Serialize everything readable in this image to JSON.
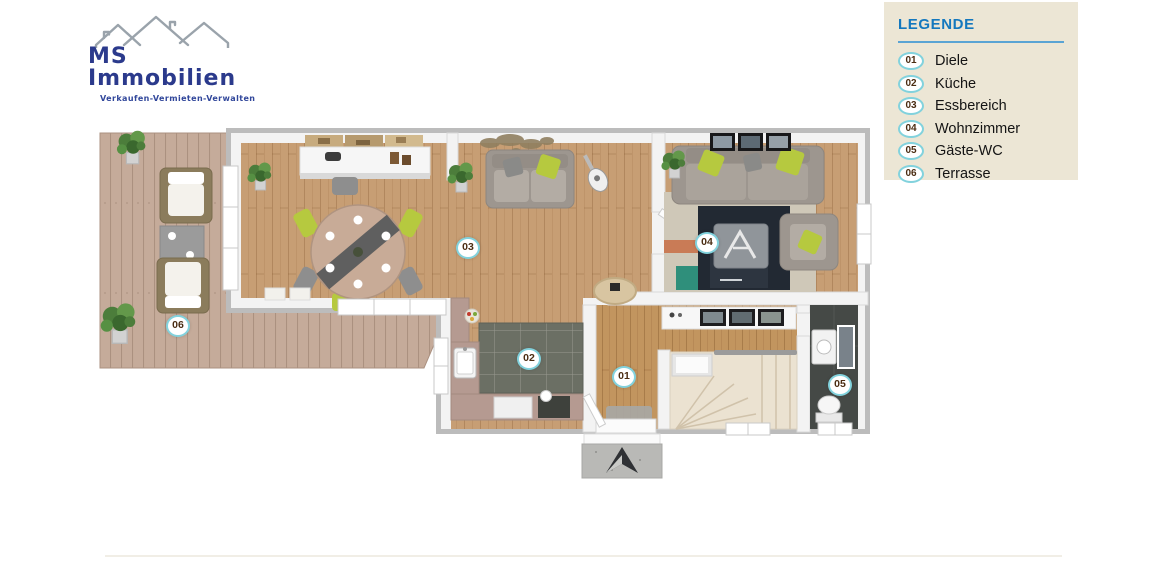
{
  "logo": {
    "name": "MS Immobilien",
    "tagline": "Verkaufen-Vermieten-Verwalten"
  },
  "legend": {
    "title": "LEGENDE",
    "items": [
      {
        "num": "01",
        "label": "Diele"
      },
      {
        "num": "02",
        "label": "Küche"
      },
      {
        "num": "03",
        "label": "Essbereich"
      },
      {
        "num": "04",
        "label": "Wohnzimmer"
      },
      {
        "num": "05",
        "label": "Gäste-WC"
      },
      {
        "num": "06",
        "label": "Terrasse"
      }
    ]
  },
  "floorplan": {
    "type": "3d-top-down-floor-plan",
    "room_markers": [
      {
        "num": "01",
        "room": "Diele",
        "x": 624,
        "y": 377
      },
      {
        "num": "02",
        "room": "Küche",
        "x": 529,
        "y": 359
      },
      {
        "num": "03",
        "room": "Essbereich",
        "x": 468,
        "y": 248
      },
      {
        "num": "04",
        "room": "Wohnzimmer",
        "x": 707,
        "y": 243
      },
      {
        "num": "05",
        "room": "Gäste-WC",
        "x": 840,
        "y": 385
      },
      {
        "num": "06",
        "room": "Terrasse",
        "x": 178,
        "y": 326
      }
    ]
  },
  "colors": {
    "logo_navy": "#2b3a8c",
    "logo_tagline": "#31479b",
    "roof_gray": "#9aa3ab",
    "legend_bg": "#ece6d5",
    "legend_blue": "#1478be",
    "legend_rule": "#5aa4d4",
    "badge_ring": "#82d2dd",
    "badge_text": "#4a2c12",
    "wall_gray": "#bcbcbc",
    "wall_white": "#f3f3f3",
    "wood_floor": "#c79e74",
    "hall_wood": "#c2955f",
    "terrace_deck": "#c5ab9a",
    "kitchen_tile": "#6b6f64",
    "counter": "#b59a91",
    "stairs": "#ebe2d1",
    "wc_floor": "#454946",
    "sofa": "#9d968f",
    "lime": "#b6c93f",
    "rug_navy": "#222933",
    "plant_green": "#4c7d3b"
  }
}
